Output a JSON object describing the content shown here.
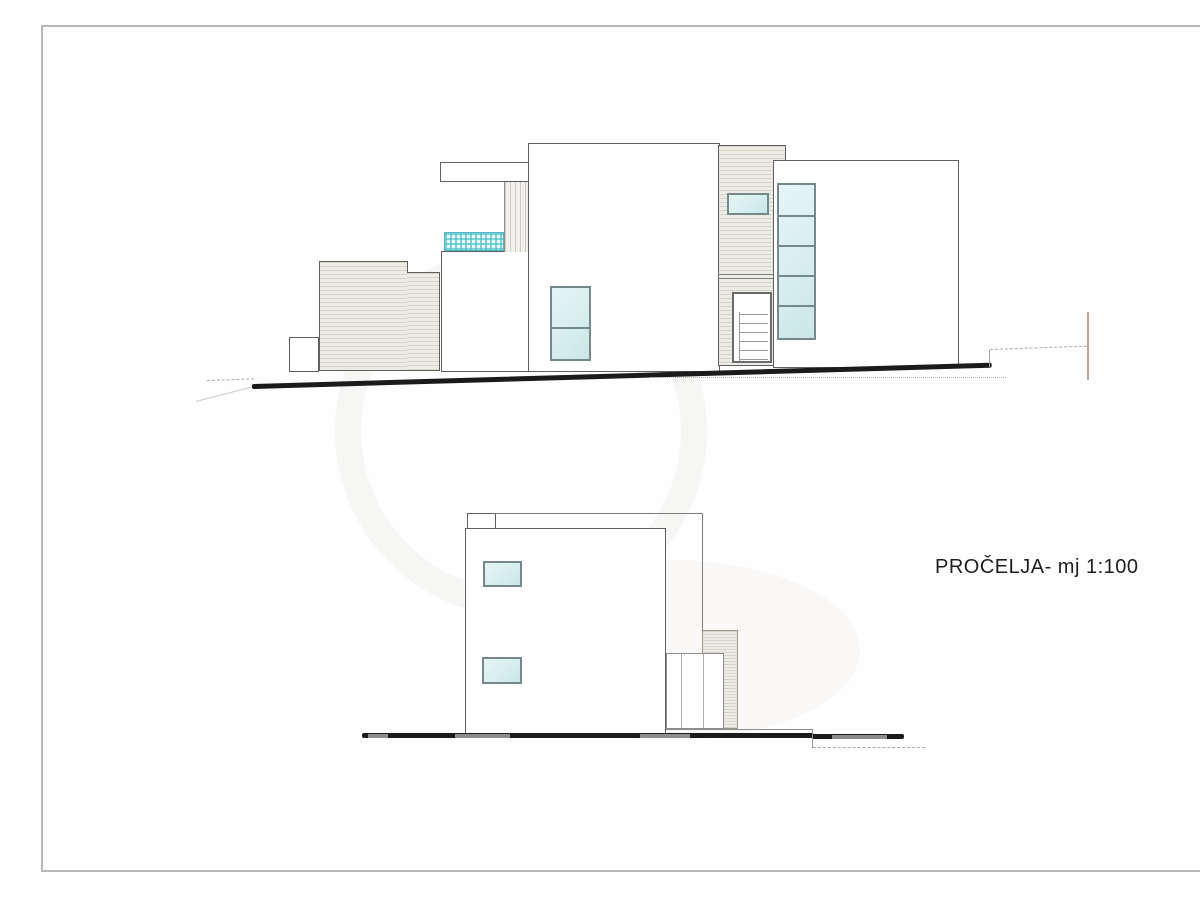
{
  "document": {
    "label": "PROČELJA- mj 1:100"
  },
  "drawings": [
    {
      "name": "upper-elevation",
      "description": "side facade on sloped terrain"
    },
    {
      "name": "lower-elevation",
      "description": "side facade on flat terrain"
    }
  ],
  "colors": {
    "frame": "#b8b8b8",
    "outline": "#5f5f5f",
    "ground": "#1b1b1b",
    "glass": "#d8eeee",
    "glass_frame": "#75898a",
    "hatch_fill": "#edebe6",
    "hatch_line": "#d8d4cc",
    "water": "#59c3cc",
    "marker": "#b7a89f",
    "text": "#1e1e1e"
  }
}
